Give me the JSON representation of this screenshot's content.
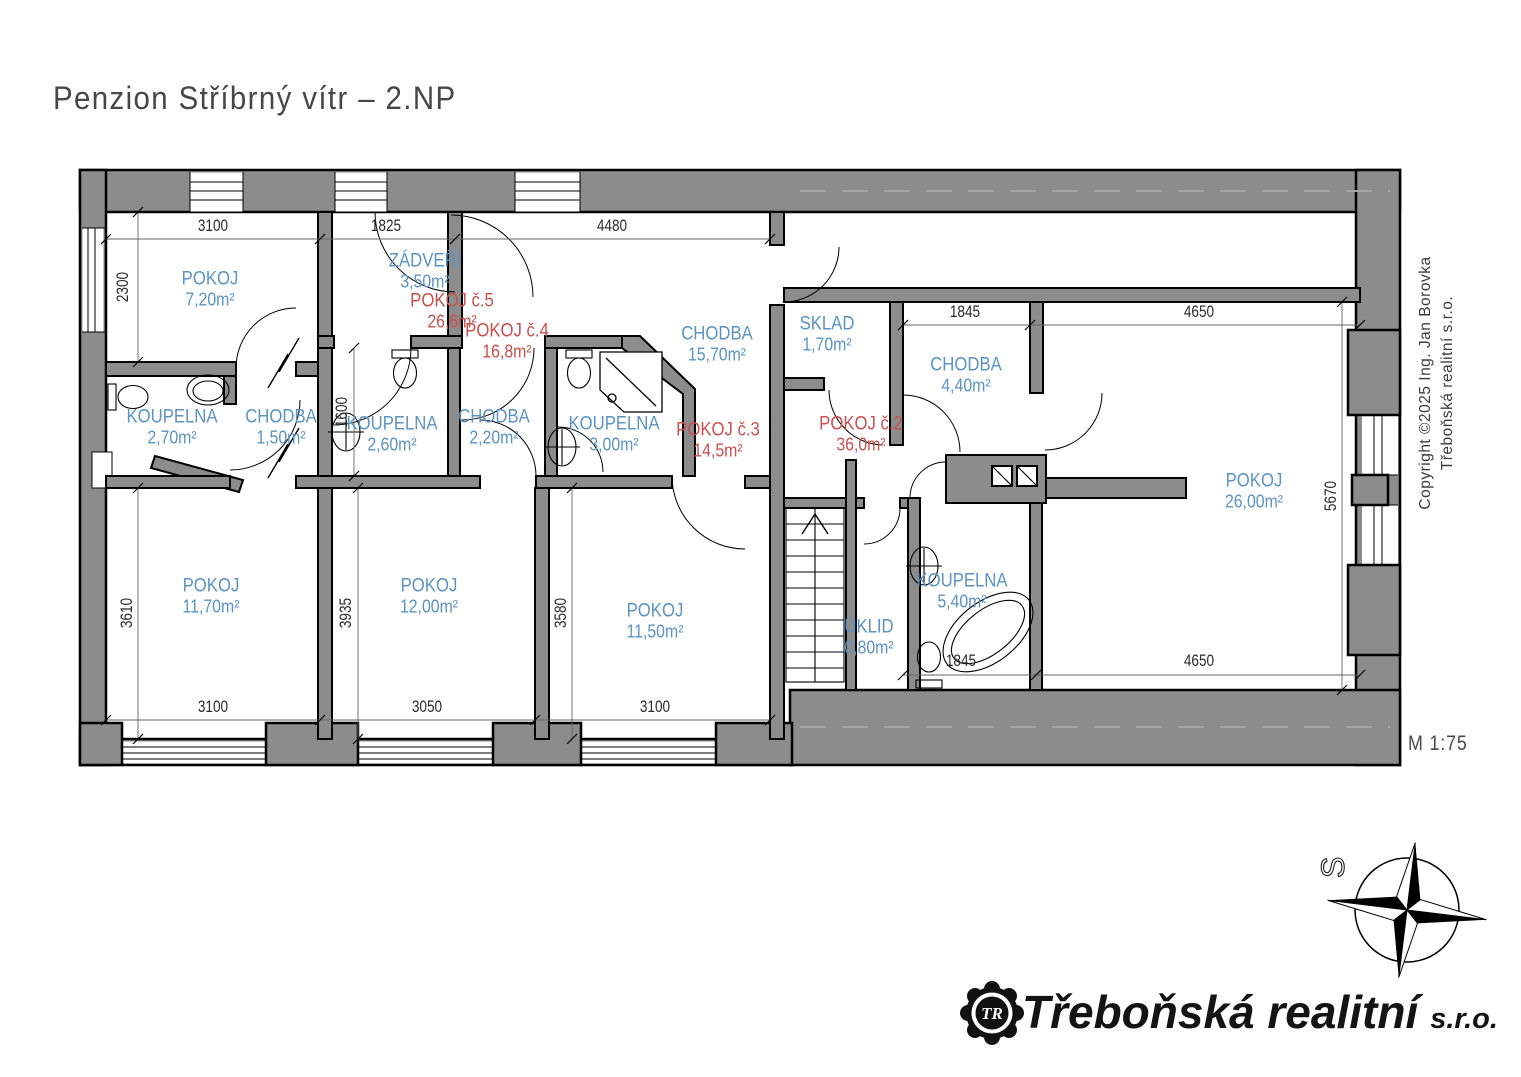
{
  "title": "Penzion Stříbrný vítr – 2.NP",
  "scale_label": "M 1:75",
  "compass_label": "S",
  "copyright": {
    "line1": "Copyright ©2025 Ing. Jan Borovka",
    "line2": "Třeboňská realitní s.r.o."
  },
  "logo": {
    "badge": "TR",
    "company": "Třeboňská realitní",
    "suffix": "s.r.o."
  },
  "colors": {
    "wall": "#8c8c8c",
    "room": "#5b94c3",
    "unit": "#c9504d",
    "dim": "#2a2a2a"
  },
  "rooms": [
    {
      "name": "POKOJ",
      "area": "7,20m²"
    },
    {
      "name": "ZÁDVEŘÍ",
      "area": "3,50m²"
    },
    {
      "name": "KOUPELNA",
      "area": "2,70m²"
    },
    {
      "name": "CHODBA",
      "area": "1,50m²"
    },
    {
      "name": "KOUPELNA",
      "area": "2,60m²"
    },
    {
      "name": "CHODBA",
      "area": "2,20m²"
    },
    {
      "name": "KOUPELNA",
      "area": "3,00m²"
    },
    {
      "name": "CHODBA",
      "area": "15,70m²"
    },
    {
      "name": "SKLAD",
      "area": "1,70m²"
    },
    {
      "name": "CHODBA",
      "area": "4,40m²"
    },
    {
      "name": "POKOJ",
      "area": "26,00m²"
    },
    {
      "name": "POKOJ",
      "area": "11,70m²"
    },
    {
      "name": "POKOJ",
      "area": "12,00m²"
    },
    {
      "name": "POKOJ",
      "area": "11,50m²"
    },
    {
      "name": "ÚKLID",
      "area": "0,80m²"
    },
    {
      "name": "KOUPELNA",
      "area": "5,40m²"
    }
  ],
  "units": [
    {
      "name": "POKOJ č.5",
      "area": "26,6m²"
    },
    {
      "name": "POKOJ č.4",
      "area": "16,8m²"
    },
    {
      "name": "POKOJ č.3",
      "area": "14,5m²"
    },
    {
      "name": "POKOJ č.2",
      "area": "36,0m²"
    }
  ],
  "dims": [
    "3100",
    "1825",
    "4480",
    "1845",
    "4650",
    "2300",
    "3610",
    "1600",
    "3935",
    "3580",
    "5670",
    "3100",
    "3050",
    "3100",
    "1845",
    "4650"
  ]
}
